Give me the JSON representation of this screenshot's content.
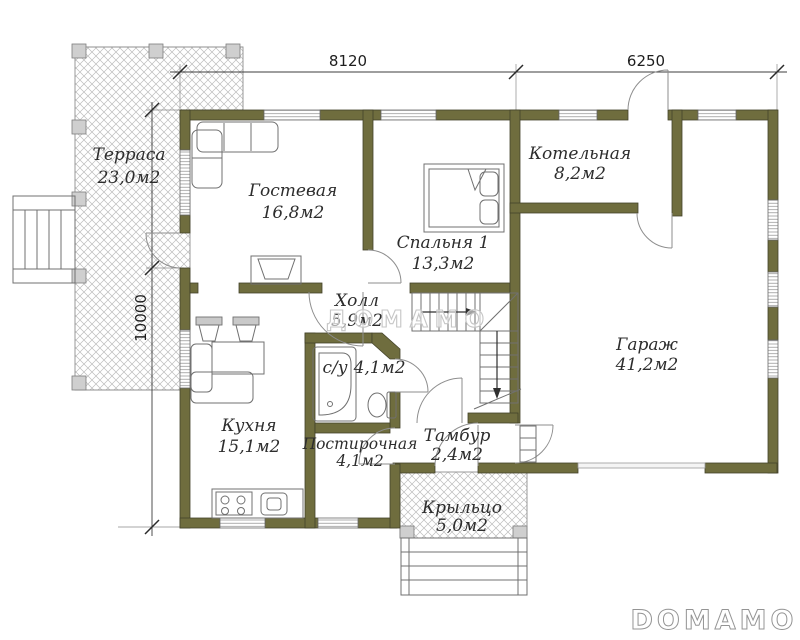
{
  "plan": {
    "dimensions": {
      "width_left": "8120",
      "width_right": "6250",
      "height": "10000"
    },
    "rooms": {
      "terrace": {
        "name": "Терраса",
        "area": "23,0м2"
      },
      "living": {
        "name": "Гостевая",
        "area": "16,8м2"
      },
      "bedroom": {
        "name": "Спальня 1",
        "area": "13,3м2"
      },
      "boiler": {
        "name": "Котельная",
        "area": "8,2м2"
      },
      "hall": {
        "name": "Холл",
        "area": "5,9м2"
      },
      "bathroom": {
        "name": "с/у",
        "area": "4,1м2"
      },
      "kitchen": {
        "name": "Кухня",
        "area": "15,1м2"
      },
      "laundry": {
        "name": "Постирочная",
        "area": "4,1м2"
      },
      "vestibule": {
        "name": "Тамбур",
        "area": "2,4м2"
      },
      "garage": {
        "name": "Гараж",
        "area": "41,2м2"
      },
      "porch": {
        "name": "Крыльцо",
        "area": "5,0м2"
      }
    },
    "watermark": "ДОМАМО",
    "brand": "DOMAMO",
    "colors": {
      "wall": "#6f6d3e",
      "hatch": "#bcbcbc",
      "label": "#2d2d2d",
      "watermark": "#c6c6c6"
    }
  }
}
